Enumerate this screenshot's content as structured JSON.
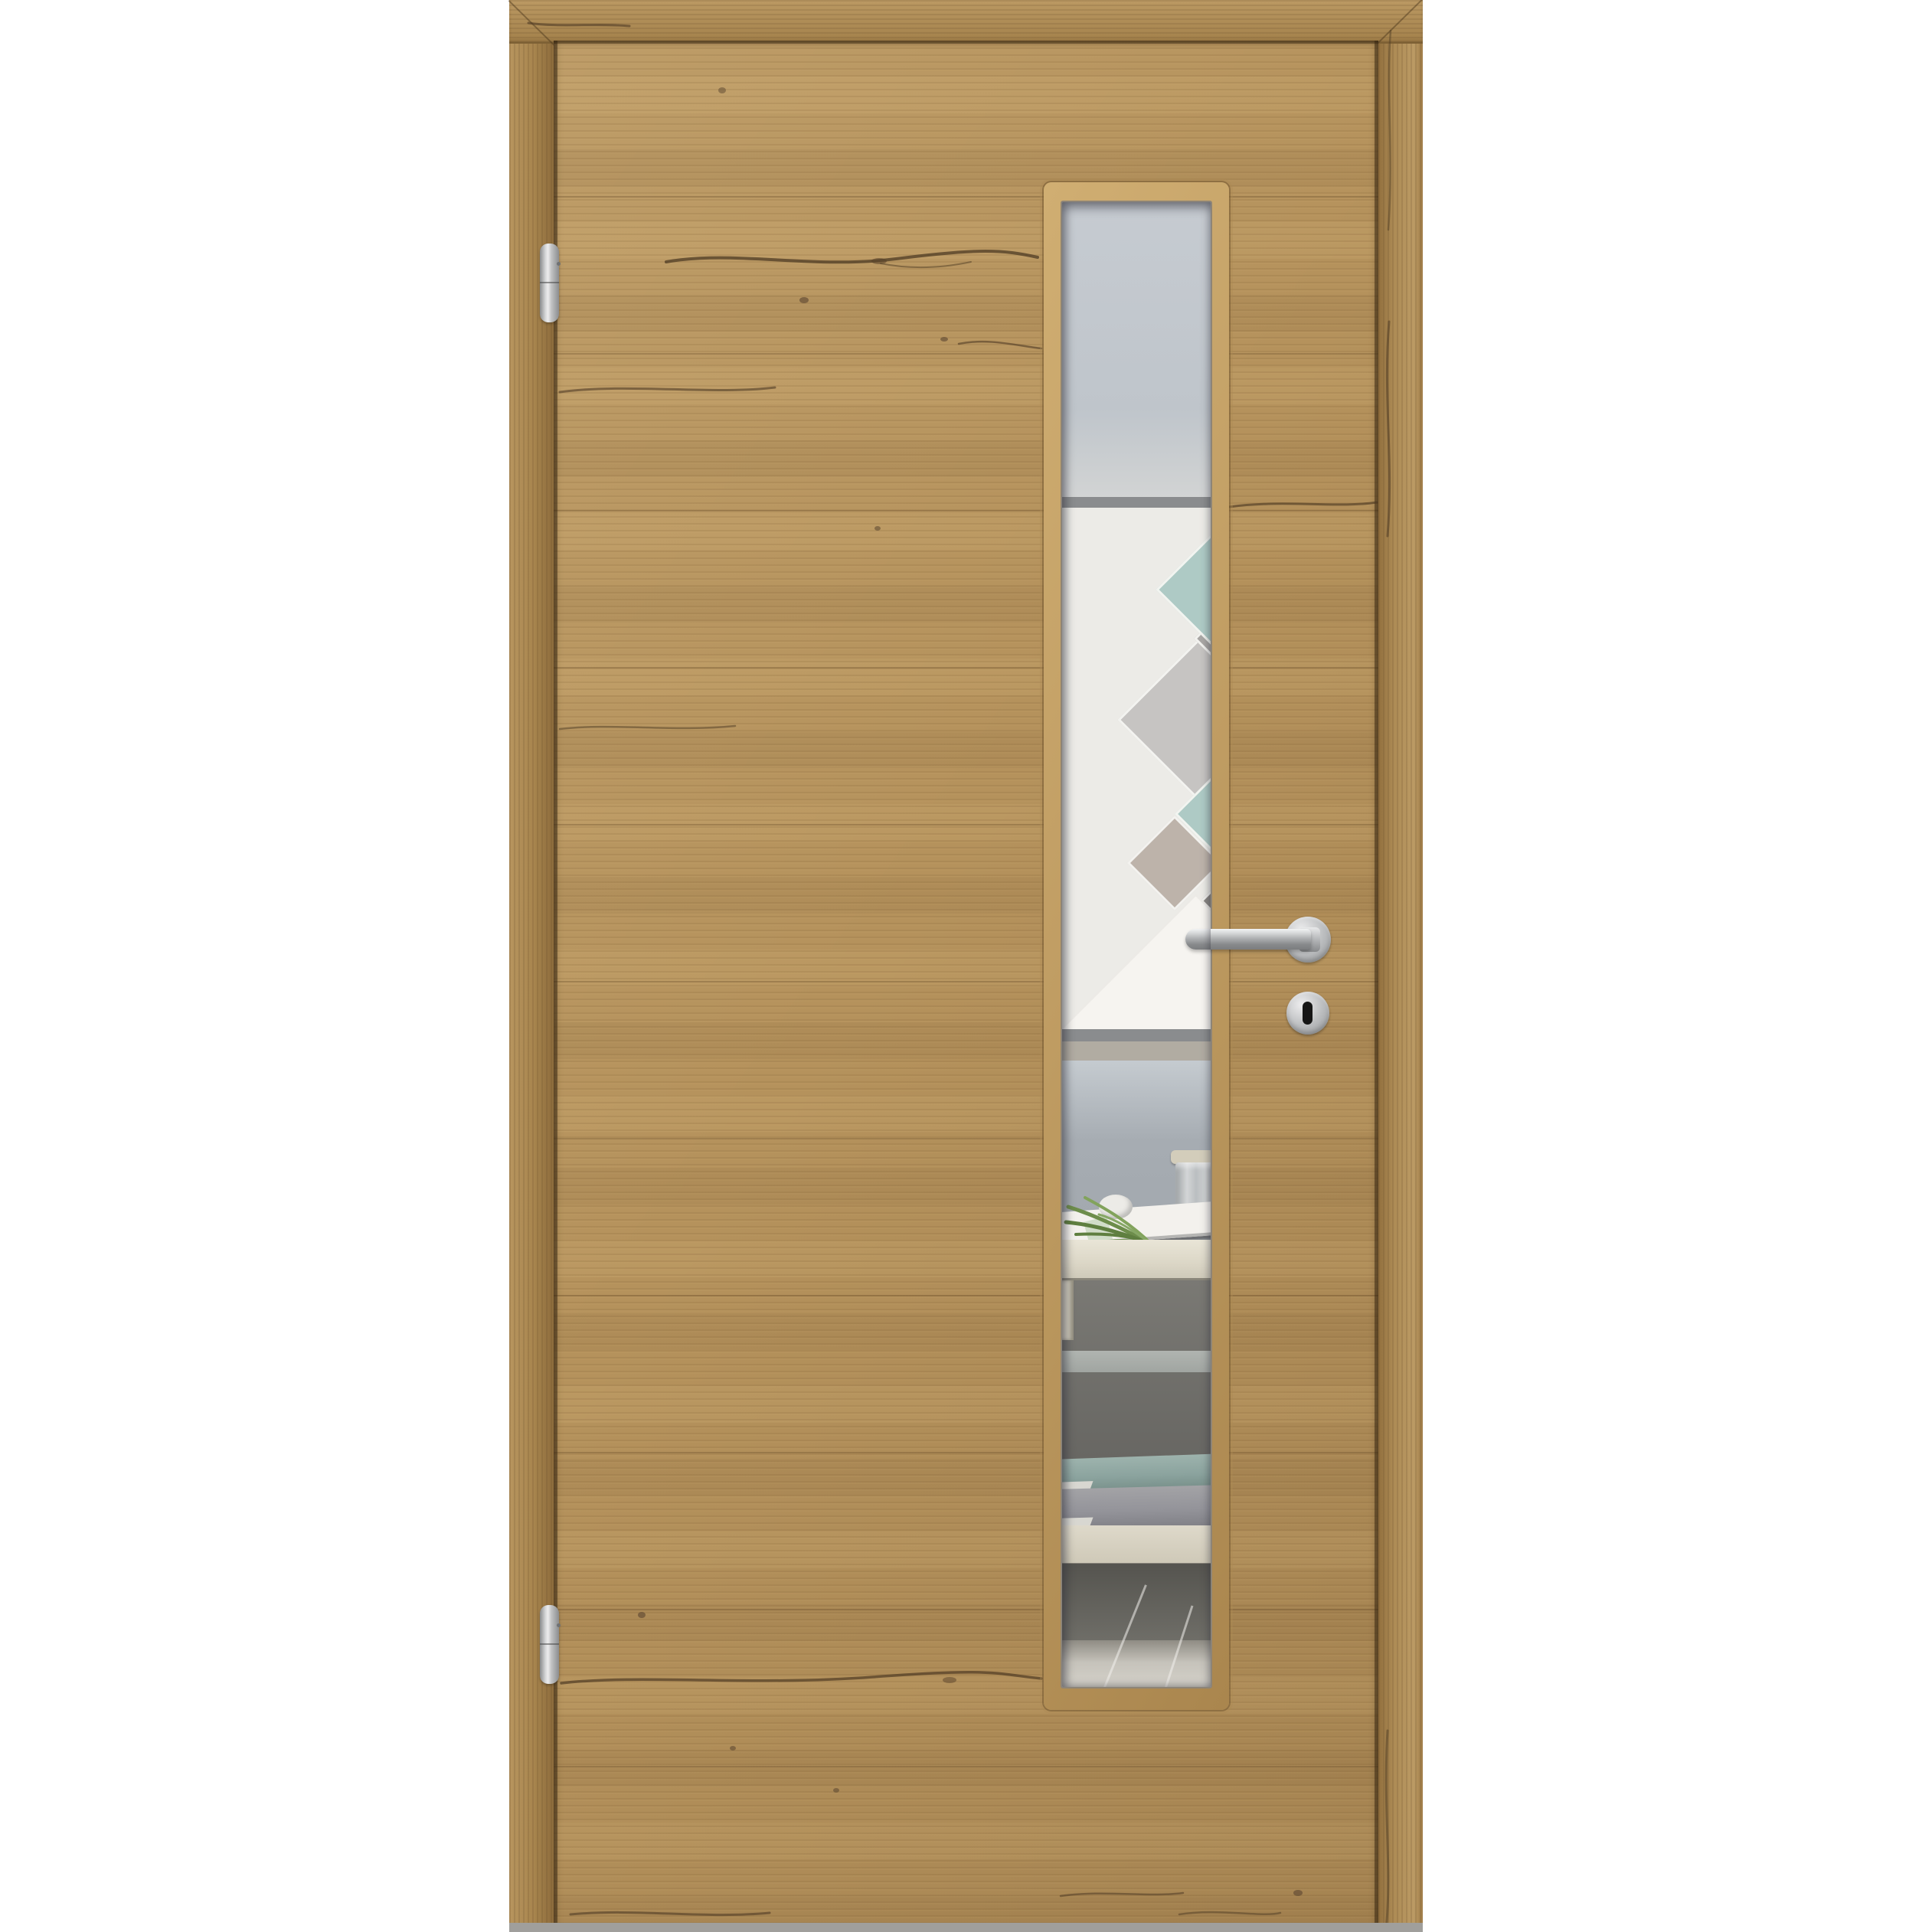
{
  "image": {
    "type": "product-photo",
    "subject": "interior wooden door, oak-style laminate, with narrow vertical glass lite, satin-steel lever handle, key escutcheon and two barrel hinges, shown in matching wood frame on white background",
    "text_content": "none"
  },
  "door": {
    "frame": {
      "casings": [
        "left",
        "top",
        "right"
      ],
      "grain": "vertical on jambs, horizontal on head"
    },
    "leaf": {
      "grain": "horizontal planks with cracks and knots"
    },
    "hinges": {
      "count": 2,
      "style": "barrel"
    },
    "handle": {
      "type": "lever",
      "side": "right"
    },
    "keyhole": {
      "type": "key escutcheon with black keyhole"
    },
    "glass": {
      "shape": "tall narrow vertical rectangle",
      "position": "right of center"
    }
  },
  "glass_scene": {
    "items": [
      "pale blue-gray upper wall panel",
      "dark panel edge line",
      "white wall with diamond mosaic",
      "gray band",
      "greige band",
      "blue-gray lower wall",
      "glass jar with beige lid",
      "white egg decor",
      "green plant leaves",
      "white book on sideboard",
      "light sideboard top and leg",
      "dark under-table shadow",
      "teal book",
      "gray book",
      "light shelf",
      "tiled floor with diagonal grout lines"
    ],
    "mosaic_diamond_colors": [
      "#aecac5",
      "#a9a7a5",
      "#c6c4c2",
      "#aecac5",
      "#bdb3aa",
      "#8a8784",
      "#f6f4f0"
    ]
  },
  "colors": {
    "bg": "#ffffff",
    "frame_wood": "#a8854e",
    "leaf_wood": "#b5925c",
    "bevel_light": "#d0ae72",
    "bevel_dark": "#aa864e",
    "crack": "#4e3b24",
    "metal_light": "#ededee",
    "metal_mid": "#b9bbbd",
    "metal_dark": "#939597",
    "glass_wall_top": "#c6cbd1",
    "band_dark": "#8a8c8e",
    "wall_white": "#ecebe7",
    "band_greige": "#b1aca2",
    "wall_blue_gray": "#a6acb2",
    "diamond_teal": "#aecac5",
    "diamond_gray_light": "#c6c4c2",
    "diamond_gray_mid": "#a9a7a5",
    "diamond_gray_dark": "#8a8784",
    "diamond_greige": "#bdb3aa",
    "diamond_white": "#f6f4f0",
    "table_top": "#dcd7c7",
    "under_table": "#6a6965",
    "book_teal": "#8ba39e",
    "book_gray": "#94949a",
    "book_white": "#f3f1ed",
    "shelf": "#cfc9b8",
    "floor": "#c6c3bb",
    "jar_lid": "#d3cdbb",
    "egg": "#ecebe7",
    "plant_green": "#6d8d4b",
    "keyhole": "#161616",
    "floor_strip": "#a09f9c"
  }
}
